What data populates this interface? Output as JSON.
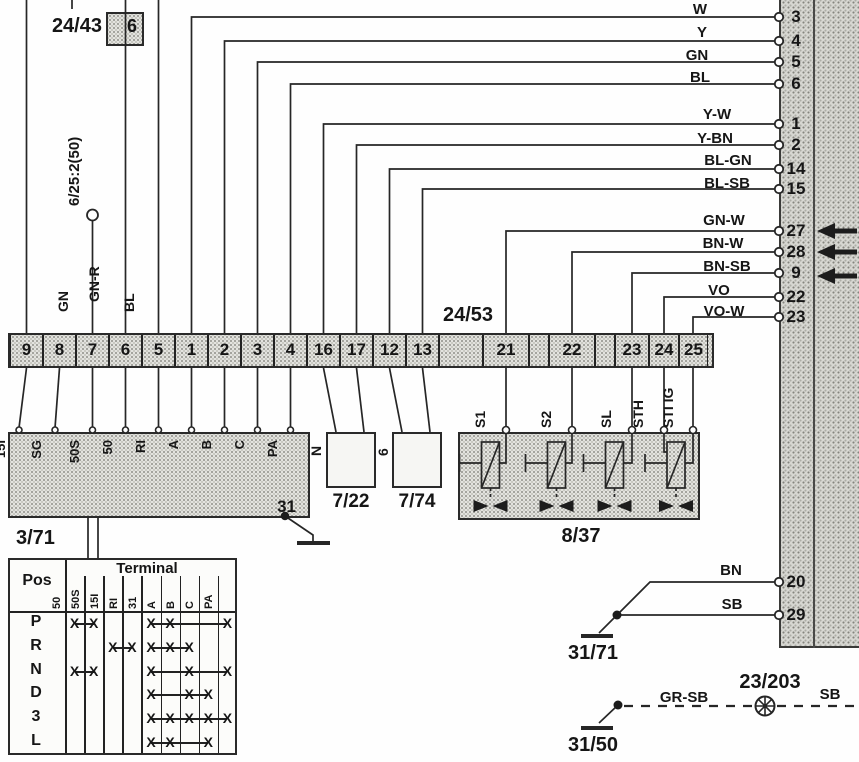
{
  "components": {
    "c2443": {
      "label": "24/43",
      "pin": "6"
    },
    "c625": {
      "label": "6/25:2(50)"
    },
    "c2453": {
      "label": "24/53",
      "cells": [
        "9",
        "8",
        "7",
        "6",
        "5",
        "1",
        "2",
        "3",
        "4",
        "16",
        "17",
        "12",
        "13",
        "",
        "21",
        "",
        "22",
        "",
        "23",
        "24",
        "25"
      ]
    },
    "c371": {
      "label": "3/71",
      "ground_pin": "31",
      "pins": [
        "15I",
        "SG",
        "50S",
        "50",
        "RI",
        "A",
        "B",
        "C",
        "PA"
      ]
    },
    "c722": {
      "label": "7/22",
      "glyph": "N"
    },
    "c774": {
      "label": "7/74",
      "glyph": "6"
    },
    "c837": {
      "label": "8/37",
      "pins": [
        "S1",
        "S2",
        "SL",
        "STH",
        "STI IG"
      ]
    },
    "g3171": {
      "label": "31/71"
    },
    "g3150": {
      "label": "31/50"
    },
    "splice": {
      "label": "23/203"
    }
  },
  "left_wires": [
    "BL-GR",
    "GN",
    "GN-R",
    "BL"
  ],
  "right_terminals": [
    {
      "wire": "W",
      "terminal": "3"
    },
    {
      "wire": "Y",
      "terminal": "4"
    },
    {
      "wire": "GN",
      "terminal": "5"
    },
    {
      "wire": "BL",
      "terminal": "6"
    },
    {
      "wire": "Y-W",
      "terminal": "1"
    },
    {
      "wire": "Y-BN",
      "terminal": "2"
    },
    {
      "wire": "BL-GN",
      "terminal": "14"
    },
    {
      "wire": "BL-SB",
      "terminal": "15"
    },
    {
      "wire": "GN-W",
      "terminal": "27"
    },
    {
      "wire": "BN-W",
      "terminal": "28"
    },
    {
      "wire": "BN-SB",
      "terminal": "9"
    },
    {
      "wire": "VO",
      "terminal": "22"
    },
    {
      "wire": "VO-W",
      "terminal": "23"
    },
    {
      "wire": "BN",
      "terminal": "20"
    },
    {
      "wire": "SB",
      "terminal": "29"
    }
  ],
  "splice_wires": {
    "left": "GR-SB",
    "right": "SB"
  },
  "table": {
    "pos_header": "Pos",
    "terminal_header": "Terminal",
    "columns": [
      "50",
      "50S",
      "15I",
      "RI",
      "31",
      "A",
      "B",
      "C",
      "PA"
    ],
    "rows": [
      {
        "pos": "P",
        "groups": [
          [
            0,
            1
          ],
          [
            4,
            5,
            8
          ]
        ]
      },
      {
        "pos": "R",
        "groups": [
          [
            2,
            3
          ],
          [
            4,
            5,
            6
          ]
        ]
      },
      {
        "pos": "N",
        "groups": [
          [
            0,
            1
          ],
          [
            4,
            6,
            8
          ]
        ]
      },
      {
        "pos": "D",
        "groups": [
          [
            4,
            6,
            7
          ]
        ]
      },
      {
        "pos": "3",
        "groups": [
          [
            4,
            5,
            6,
            7,
            8
          ]
        ]
      },
      {
        "pos": "L",
        "groups": [
          [
            4,
            5,
            7
          ]
        ]
      }
    ]
  }
}
